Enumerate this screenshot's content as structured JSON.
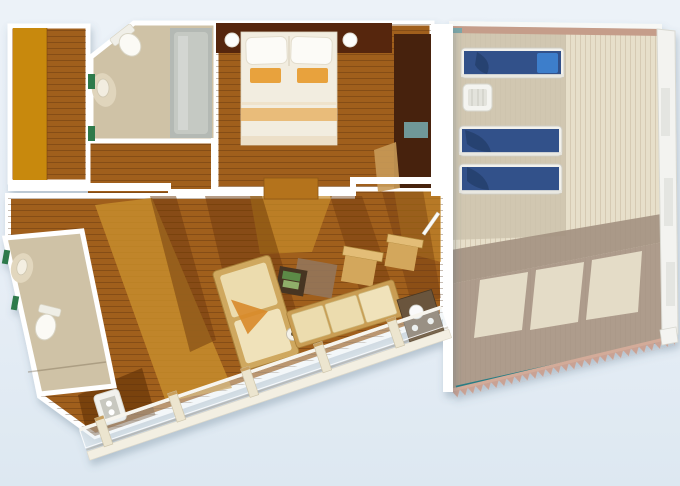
{
  "image": {
    "kind": "3d-floor-plan",
    "subject": "cruise-ship-suite-aerial-floor-plan",
    "text_visible": "none"
  },
  "rooms": [
    {
      "name": "walk-in-closet",
      "position": "top-left",
      "features": [
        "orange-wardrobe-strip",
        "wood-plank-floor"
      ]
    },
    {
      "name": "bathroom-upper",
      "position": "top-left-center",
      "features": [
        "toilet",
        "sink",
        "bathtub",
        "green-shelf-accents",
        "angled-corner-wall"
      ]
    },
    {
      "name": "bedroom",
      "position": "top-center",
      "features": [
        "double-bed",
        "two-white-pillows",
        "two-orange-accent-pillows",
        "foot-stripe-runner",
        "dark-headboard-wall",
        "two-round-bedside-lamps",
        "tall-dark-tv-cabinet",
        "teal-tv-screen"
      ]
    },
    {
      "name": "living-room",
      "position": "center",
      "features": [
        "cream-chaise-sofa",
        "two-wood-armchairs",
        "grey-rug",
        "dark-tray-table-with-green-books",
        "tan-sideboard",
        "round-floor-lamp",
        "sunlight-and-shadow-patches",
        "entry-door"
      ]
    },
    {
      "name": "bathroom-lower",
      "position": "bottom-left",
      "features": [
        "toilet",
        "sink",
        "green-shelf-accents",
        "tilted-layout"
      ]
    },
    {
      "name": "veranda",
      "position": "bottom",
      "features": [
        "glass-railing-with-posts",
        "outdoor-sofa-with-cream-cushions",
        "dark-serving-table-with-white-teaset",
        "white-side-table"
      ]
    },
    {
      "name": "balcony-deck",
      "position": "right",
      "features": [
        "three-blue-sun-loungers",
        "white-slatted-side-table",
        "white-outer-railing",
        "railing-shadow-bands",
        "three-light-window-patches",
        "serrated-deck-edge",
        "teal-trim-line"
      ]
    }
  ],
  "furniture_counts": {
    "sun_loungers": 3,
    "beds": 1,
    "toilets": 2,
    "bathtubs": 1,
    "sofas": 2,
    "armchairs": 2,
    "side_tables": 4
  },
  "colors": {
    "background_top": "#ecf2f8",
    "background_bottom": "#dde8f1",
    "wall": "#ffffff",
    "wood_floor": "#a05e1c",
    "floor_shadow": "#6e3a0c",
    "floor_highlight": "#c68c2b",
    "closet_orange": "#c8890f",
    "bathroom_floor": "#cfc2a6",
    "bathtub": "#b4b9b4",
    "green_accent": "#2f7a4c",
    "headboard": "#572708",
    "bed_linen": "#f2ede0",
    "bed_accent": "#e8a23c",
    "bed_stripe": "#e9bc7a",
    "cabinet_dark": "#46200a",
    "tv_screen": "#6f9898",
    "deck_light": "#e7dfca",
    "deck_mid": "#cdc3ad",
    "deck_shadow": "#a39181",
    "lounger_blue": "#33518a",
    "lounger_towel": "#26406e",
    "lounger_pillow": "#3e7ecb",
    "lounger_frame": "#f2f1ec",
    "rail_band": "#c59d8a",
    "serrated_edge": "#c9a294",
    "teal_trim": "#2a7d84",
    "sofa_cushion": "#ecdcae",
    "sofa_frame": "#cfa85f",
    "outdoor_sofa_frame": "#c99d52",
    "table_dark": "#6a543c",
    "railing_cream": "#f3efe2",
    "sideboard_tan": "#b4731c"
  }
}
